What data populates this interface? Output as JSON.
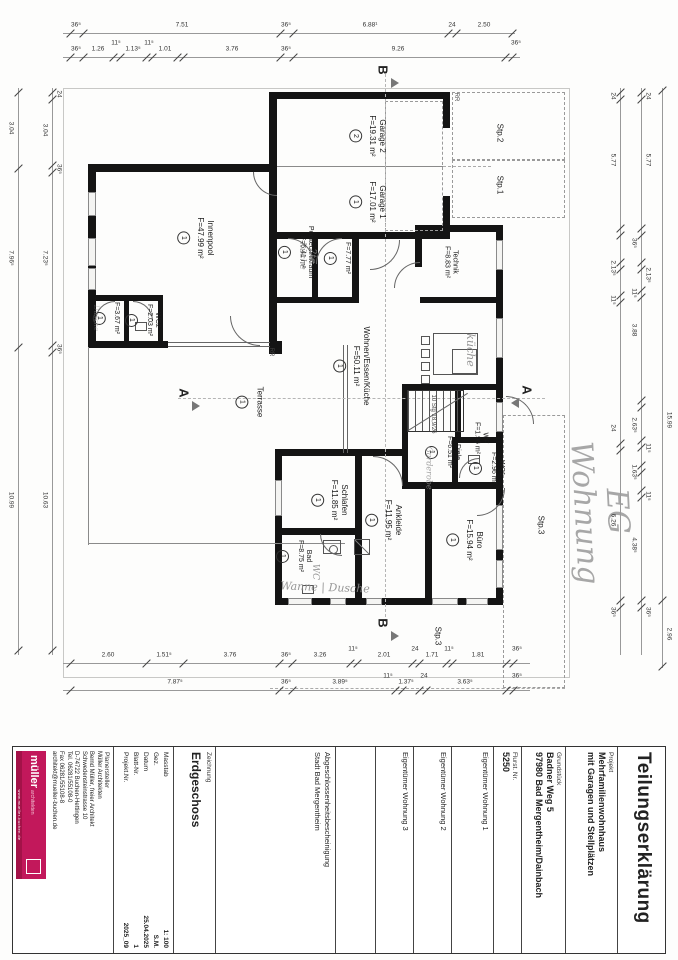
{
  "plan": {
    "rooms": [
      {
        "name": "Garage 2",
        "area": "F=19.31 m²",
        "unit": "2",
        "x": 368,
        "y": 136,
        "small": false
      },
      {
        "name": "Garage 1",
        "area": "F=17.01 m²",
        "unit": "1",
        "x": 368,
        "y": 202,
        "small": false
      },
      {
        "name": "Innenpool",
        "area": "F=47.99 m²",
        "unit": "1",
        "x": 196,
        "y": 238,
        "small": false
      },
      {
        "name": "Pooltechnikraum",
        "area": "F=6.41 m²",
        "unit": "1",
        "x": 296,
        "y": 252,
        "small": true
      },
      {
        "name": "",
        "area": "F=7.77 m²",
        "unit": "1",
        "x": 337,
        "y": 258,
        "small": true
      },
      {
        "name": "Technik",
        "area": "F=8.83 m²",
        "unit": "",
        "x": 450,
        "y": 262,
        "small": true
      },
      {
        "name": "WC2",
        "area": "F=2.03 m²",
        "unit": "1",
        "x": 143,
        "y": 320,
        "small": true
      },
      {
        "name": "",
        "area": "F=3.67 m²",
        "unit": "1",
        "x": 106,
        "y": 318,
        "small": true
      },
      {
        "name": "Wohnen/Essen/Küche",
        "area": "F=50.11 m²",
        "unit": "1",
        "x": 352,
        "y": 366,
        "small": false
      },
      {
        "name": "Terrasse",
        "area": "",
        "unit": "1",
        "x": 250,
        "y": 402,
        "small": false
      },
      {
        "name": "Diele",
        "area": "F=6.51 m²",
        "unit": "1",
        "x": 443,
        "y": 452,
        "small": true
      },
      {
        "name": "WF",
        "area": "F=1.96 m²",
        "unit": "",
        "x": 480,
        "y": 438,
        "small": true
      },
      {
        "name": "WC1",
        "area": "F=2.96 m²",
        "unit": "1",
        "x": 487,
        "y": 468,
        "small": true
      },
      {
        "name": "Schlafen",
        "area": "F=11.85 m²",
        "unit": "1",
        "x": 330,
        "y": 500,
        "small": false
      },
      {
        "name": "Bad",
        "area": "F=8.75 m²",
        "unit": "1",
        "x": 294,
        "y": 556,
        "small": true
      },
      {
        "name": "Ankleide",
        "area": "F=11.95 m²",
        "unit": "1",
        "x": 384,
        "y": 520,
        "small": false
      },
      {
        "name": "Büro",
        "area": "F=15.94 m²",
        "unit": "1",
        "x": 465,
        "y": 540,
        "small": false
      }
    ],
    "parking_labels": [
      {
        "t": "Stp.2",
        "x": 500,
        "y": 133
      },
      {
        "t": "Stp.1",
        "x": 500,
        "y": 185
      },
      {
        "t": "Stp.3",
        "x": 541,
        "y": 525
      },
      {
        "t": "Stp.3",
        "x": 438,
        "y": 636
      }
    ],
    "section_markers": [
      {
        "t": "B",
        "x": 383,
        "y": 70,
        "dir": "right"
      },
      {
        "t": "B",
        "x": 383,
        "y": 623,
        "dir": "right"
      },
      {
        "t": "A",
        "x": 184,
        "y": 393,
        "dir": "right"
      },
      {
        "t": "A",
        "x": 527,
        "y": 390,
        "dir": "left"
      }
    ],
    "small_labels": [
      {
        "t": "RR",
        "x": 456,
        "y": 97
      },
      {
        "t": "RR",
        "x": 271,
        "y": 352
      },
      {
        "t": "10 Stg 18,9/26",
        "x": 433,
        "y": 414
      }
    ],
    "handwriting": [
      {
        "t": "EG Wohnung",
        "x": 601,
        "y": 512,
        "rot": 87,
        "size": 30,
        "op": 0.75
      },
      {
        "t": "2te\nküche",
        "x": 306,
        "y": 256,
        "rot": 90,
        "size": 9,
        "op": 0.9
      },
      {
        "t": "küche",
        "x": 470,
        "y": 350,
        "rot": 90,
        "size": 11,
        "op": 0.9
      },
      {
        "t": "Wanne | Dusche",
        "x": 325,
        "y": 588,
        "rot": 2,
        "size": 11,
        "op": 0.9
      },
      {
        "t": "WC",
        "x": 314,
        "y": 572,
        "rot": 90,
        "size": 9,
        "op": 0.9
      },
      {
        "t": "Garderobe",
        "x": 428,
        "y": 468,
        "rot": 90,
        "size": 8,
        "op": 0.8
      },
      {
        "t": "Dusche",
        "x": 95,
        "y": 318,
        "rot": 90,
        "size": 7,
        "op": 0.45
      }
    ],
    "dim_chains": [
      {
        "o": "h",
        "pos": 33,
        "a": 63,
        "b": 515,
        "ticks": [
          70,
          83,
          280,
          293,
          448,
          456,
          512
        ],
        "labels": [
          {
            "t": "36⁵",
            "at": 76,
            "off": -8
          },
          {
            "t": "7.51",
            "at": 182,
            "off": -8
          },
          {
            "t": "36⁵",
            "at": 286,
            "off": -8
          },
          {
            "t": "6.88¹",
            "at": 370,
            "off": -8
          },
          {
            "t": "24",
            "at": 452,
            "off": -8
          },
          {
            "t": "2.50",
            "at": 484,
            "off": -8
          }
        ]
      },
      {
        "o": "h",
        "pos": 57,
        "a": 63,
        "b": 520,
        "ticks": [
          70,
          83,
          113,
          120,
          146,
          152,
          177,
          183,
          280,
          293,
          505,
          512
        ],
        "labels": [
          {
            "t": "36⁵",
            "at": 76,
            "off": -8
          },
          {
            "t": "1.26",
            "at": 98,
            "off": -8
          },
          {
            "t": "11⁵",
            "at": 116,
            "off": -14
          },
          {
            "t": "1.13⁵",
            "at": 133,
            "off": -8
          },
          {
            "t": "11⁵",
            "at": 149,
            "off": -14
          },
          {
            "t": "1.01",
            "at": 165,
            "off": -8
          },
          {
            "t": "3.76",
            "at": 232,
            "off": -8
          },
          {
            "t": "36⁵",
            "at": 286,
            "off": -8
          },
          {
            "t": "9.26",
            "at": 398,
            "off": -8
          },
          {
            "t": "36⁵",
            "at": 516,
            "off": -14
          }
        ]
      },
      {
        "o": "h",
        "pos": 663,
        "a": 63,
        "b": 530,
        "ticks": [
          70,
          146,
          183,
          279,
          292,
          350,
          357,
          412,
          419,
          446,
          452,
          506,
          513
        ],
        "labels": [
          {
            "t": "2.60",
            "at": 108,
            "off": -8
          },
          {
            "t": "1.51⁵",
            "at": 164,
            "off": -8
          },
          {
            "t": "3.76",
            "at": 230,
            "off": -8
          },
          {
            "t": "36⁵",
            "at": 286,
            "off": -8
          },
          {
            "t": "3.26",
            "at": 320,
            "off": -8
          },
          {
            "t": "11⁵",
            "at": 353,
            "off": -14
          },
          {
            "t": "2.01",
            "at": 384,
            "off": -8
          },
          {
            "t": "24",
            "at": 415,
            "off": -14
          },
          {
            "t": "1.71",
            "at": 432,
            "off": -8
          },
          {
            "t": "11⁵",
            "at": 449,
            "off": -14
          },
          {
            "t": "1.81",
            "at": 478,
            "off": -8
          },
          {
            "t": "36⁵",
            "at": 517,
            "off": -14
          }
        ]
      },
      {
        "o": "h",
        "pos": 690,
        "a": 63,
        "b": 530,
        "ticks": [
          70,
          279,
          292,
          395,
          402,
          419,
          426,
          506,
          513
        ],
        "labels": [
          {
            "t": "7.87⁵",
            "at": 175,
            "off": -8
          },
          {
            "t": "36⁵",
            "at": 286,
            "off": -8
          },
          {
            "t": "3.89⁵",
            "at": 340,
            "off": -8
          },
          {
            "t": "11⁵",
            "at": 388,
            "off": -14
          },
          {
            "t": "1.37⁵",
            "at": 406,
            "off": -8
          },
          {
            "t": "24",
            "at": 424,
            "off": -14
          },
          {
            "t": "3.63⁵",
            "at": 465,
            "off": -8
          },
          {
            "t": "36⁵",
            "at": 517,
            "off": -14
          }
        ]
      },
      {
        "o": "v",
        "pos": 18,
        "a": 88,
        "b": 655,
        "ticks": [
          92,
          168,
          347,
          650
        ],
        "labels": [
          {
            "t": "3.04",
            "at": 128,
            "off": -7
          },
          {
            "t": "7.96⁵",
            "at": 258,
            "off": -7
          },
          {
            "t": "10.99",
            "at": 500,
            "off": -7
          }
        ]
      },
      {
        "o": "v",
        "pos": 52,
        "a": 88,
        "b": 655,
        "ticks": [
          92,
          99,
          165,
          172,
          345,
          352,
          650
        ],
        "labels": [
          {
            "t": "24",
            "at": 94,
            "off": 7
          },
          {
            "t": "3.04",
            "at": 130,
            "off": -7
          },
          {
            "t": "36⁵",
            "at": 169,
            "off": 7
          },
          {
            "t": "7.23⁵",
            "at": 258,
            "off": -7
          },
          {
            "t": "36⁵",
            "at": 349,
            "off": 7
          },
          {
            "t": "10.63",
            "at": 500,
            "off": -7
          }
        ]
      },
      {
        "o": "v",
        "pos": 620,
        "a": 88,
        "b": 655,
        "ticks": [
          92,
          99,
          228,
          235,
          262,
          269,
          295,
          302,
          443,
          450,
          600,
          607
        ],
        "labels": [
          {
            "t": "24",
            "at": 96,
            "off": -7
          },
          {
            "t": "5.77",
            "at": 160,
            "off": -7
          },
          {
            "t": "2.13⁵",
            "at": 268,
            "off": -7
          },
          {
            "t": "11⁵",
            "at": 300,
            "off": -7
          },
          {
            "t": "24",
            "at": 428,
            "off": -7
          },
          {
            "t": "6.26",
            "at": 520,
            "off": -7
          },
          {
            "t": "36⁵",
            "at": 612,
            "off": -7
          }
        ]
      },
      {
        "o": "v",
        "pos": 641,
        "a": 88,
        "b": 655,
        "ticks": [
          92,
          99,
          228,
          235,
          262,
          269,
          290,
          297,
          400,
          407,
          440,
          447,
          465,
          472,
          490,
          497,
          600,
          607
        ],
        "labels": [
          {
            "t": "24",
            "at": 96,
            "off": 7
          },
          {
            "t": "5.77",
            "at": 160,
            "off": 7
          },
          {
            "t": "36⁵",
            "at": 243,
            "off": -7
          },
          {
            "t": "2.13⁵",
            "at": 275,
            "off": 7
          },
          {
            "t": "11⁵",
            "at": 293,
            "off": -7
          },
          {
            "t": "3.88",
            "at": 330,
            "off": -7
          },
          {
            "t": "2.63⁵",
            "at": 425,
            "off": -7
          },
          {
            "t": "11⁵",
            "at": 448,
            "off": 7
          },
          {
            "t": "1.63⁵",
            "at": 472,
            "off": -7
          },
          {
            "t": "11⁵",
            "at": 496,
            "off": 7
          },
          {
            "t": "4.38⁵",
            "at": 545,
            "off": -7
          },
          {
            "t": "36⁵",
            "at": 612,
            "off": 7
          }
        ]
      },
      {
        "o": "v",
        "pos": 662,
        "a": 88,
        "b": 668,
        "ticks": [
          90,
          600,
          666
        ],
        "labels": [
          {
            "t": "15.99",
            "at": 420,
            "off": 7
          },
          {
            "t": "2.96",
            "at": 634,
            "off": 7
          }
        ]
      }
    ]
  },
  "title_block": {
    "title": "Teilungserklärung",
    "project_label": "Projekt",
    "project_lines": [
      "Mehrfamilienwohnhaus",
      "mit Garagen und Stellplätzen"
    ],
    "site_label": "Grundstück",
    "site_lines": [
      "Badner Weg 5",
      "97980 Bad Mergentheim/Dainbach"
    ],
    "parcel_label": "Flurst. Nr.",
    "parcel": "5250",
    "owners": [
      "Eigentümer Wohnung 1",
      "Eigentümer Wohnung 2",
      "Eigentümer Wohnung 3"
    ],
    "certificate_lines": [
      "Abgeschlossenheitsbescheinigung",
      "Stadt Bad Mergentheim"
    ],
    "drawing_label": "Zeichnung",
    "drawing": "Erdgeschoss",
    "meta": [
      {
        "label": "Masstab",
        "value": "1: 100"
      },
      {
        "label": "Gez.",
        "value": "S.M."
      },
      {
        "label": "Datum",
        "value": "25.04.2025"
      },
      {
        "label": "Blatt-Nr.",
        "value": "1"
      },
      {
        "label": "Projekt.Nr.",
        "value": "2025_09"
      }
    ],
    "planner_label": "Planersteller",
    "logo": {
      "brand": "müller",
      "sub": "architekten",
      "web": "www.mueller-buchen.de",
      "color": "#c2185b"
    },
    "address_lines": [
      "Müller Architekten",
      "Bernd Müller, freier Architekt",
      "Schwedensteinstrasse 10",
      "D-74722 Buchen-Hettingen",
      "Tel. 06281/55108-0",
      "Fax 06281/55108-8",
      "architekt@mueller-buchen.de"
    ]
  }
}
